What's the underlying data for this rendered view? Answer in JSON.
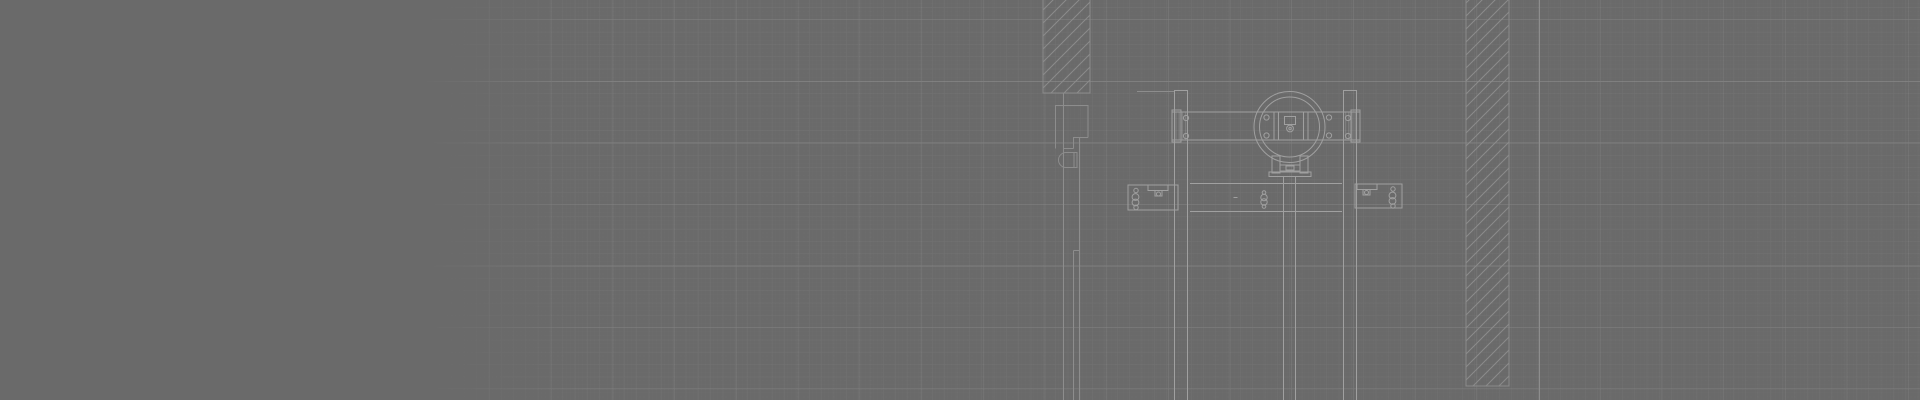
{
  "canvas": {
    "width": 1920,
    "height": 400,
    "background": "#6a6a6a",
    "line_color_bright": "#a0a0a0",
    "line_color_dim": "#8d8d8d",
    "hatch_color": "#8b8b8b",
    "section_fill_color": "rgba(255,255,255,0.16)",
    "grid": {
      "origin_x": 58,
      "origin_y": 20,
      "minor_spacing": 12.32,
      "major_spacing_x": 61.7,
      "major_spacing_y": 61.5,
      "fine_spacing": 4.1,
      "minor_color": "rgba(255,255,255,0.05)",
      "major_color": "rgba(255,255,255,0.115)",
      "fine_color": "rgba(255,255,255,0.02)",
      "fade_start_x": 420,
      "fade_full_x": 585
    }
  },
  "drawing": {
    "description": "CAD section detail: sliding-door trolley hanger assembly between hatched wall sections on gray drafting grid",
    "elements": [
      {
        "t": "hrect",
        "name": "wall-section-upper",
        "x": 1043,
        "y": -4,
        "w": 47,
        "h": 97
      },
      {
        "t": "hrect",
        "name": "wall-column-right",
        "x": 1466,
        "y": -6,
        "w": 43,
        "h": 392
      },
      {
        "t": "line",
        "name": "wall-face-line",
        "x1": 1539.5,
        "y1": 0,
        "x2": 1539.5,
        "y2": 400,
        "c": "dim"
      },
      {
        "t": "line",
        "name": "door-face-line",
        "x1": 1063.5,
        "y1": 93,
        "x2": 1063.5,
        "y2": 400,
        "c": "dim"
      },
      {
        "t": "line",
        "name": "jamb-top",
        "x1": 1055,
        "y1": 105.5,
        "x2": 1088.5,
        "y2": 105.5,
        "c": "dim"
      },
      {
        "t": "line",
        "name": "jamb-left",
        "x1": 1055.5,
        "y1": 105.5,
        "x2": 1055.5,
        "y2": 148.5,
        "c": "dim"
      },
      {
        "t": "line",
        "name": "jamb-right",
        "x1": 1088,
        "y1": 105.5,
        "x2": 1088,
        "y2": 137.5,
        "c": "dim"
      },
      {
        "t": "line",
        "name": "jamb-notch-h",
        "x1": 1073,
        "y1": 137.5,
        "x2": 1088,
        "y2": 137.5,
        "c": "dim"
      },
      {
        "t": "line",
        "name": "jamb-notch-v",
        "x1": 1073.5,
        "y1": 137.5,
        "x2": 1073.5,
        "y2": 148.5,
        "c": "dim"
      },
      {
        "t": "line",
        "name": "jamb-notch-h2",
        "x1": 1063.5,
        "y1": 148.5,
        "x2": 1073.5,
        "y2": 148.5,
        "c": "dim"
      },
      {
        "t": "path",
        "name": "door-handle-section",
        "d": "M 1077,152.5 H 1066 A 7.5 7.5 0 0 0 1066,167.5 H 1077 Z",
        "c": "dim"
      },
      {
        "t": "line",
        "name": "door-handle-inner",
        "x1": 1074,
        "y1": 152.5,
        "x2": 1074,
        "y2": 167.5,
        "c": "dim"
      },
      {
        "t": "line",
        "name": "door-track-line-a",
        "x1": 1079.5,
        "y1": 137.5,
        "x2": 1079.5,
        "y2": 400,
        "c": "dim"
      },
      {
        "t": "line",
        "name": "door-track-step",
        "x1": 1073.5,
        "y1": 250.5,
        "x2": 1079.5,
        "y2": 250.5,
        "c": "dim"
      },
      {
        "t": "line",
        "name": "door-track-line-b",
        "x1": 1073.5,
        "y1": 250.5,
        "x2": 1073.5,
        "y2": 400,
        "c": "dim"
      },
      {
        "t": "line",
        "name": "header-tick",
        "x1": 1137,
        "y1": 91.5,
        "x2": 1174,
        "y2": 91.5,
        "c": "dim"
      },
      {
        "t": "line",
        "name": "post-left-edge-a",
        "x1": 1174.5,
        "y1": 90,
        "x2": 1174.5,
        "y2": 400
      },
      {
        "t": "line",
        "name": "post-left-edge-b",
        "x1": 1187.5,
        "y1": 90,
        "x2": 1187.5,
        "y2": 400
      },
      {
        "t": "line",
        "name": "post-left-cap",
        "x1": 1174.5,
        "y1": 90.5,
        "x2": 1187.5,
        "y2": 90.5
      },
      {
        "t": "line",
        "name": "post-right-edge-a",
        "x1": 1343.5,
        "y1": 90,
        "x2": 1343.5,
        "y2": 400
      },
      {
        "t": "line",
        "name": "post-right-edge-b",
        "x1": 1356.5,
        "y1": 90,
        "x2": 1356.5,
        "y2": 400
      },
      {
        "t": "line",
        "name": "post-right-cap",
        "x1": 1343.5,
        "y1": 90.5,
        "x2": 1356.5,
        "y2": 90.5
      },
      {
        "t": "rect",
        "name": "trolley-beam",
        "x": 1172,
        "y": 112,
        "w": 188,
        "h": 28
      },
      {
        "t": "rect",
        "name": "beam-endcap-left",
        "x": 1172,
        "y": 110,
        "w": 9,
        "h": 32
      },
      {
        "t": "rect",
        "name": "beam-endcap-right",
        "x": 1351,
        "y": 110,
        "w": 9,
        "h": 32
      },
      {
        "t": "vrect",
        "name": "beam-post-section-left",
        "x": 1175,
        "y": 112.5,
        "w": 12,
        "h": 27
      },
      {
        "t": "vrect",
        "name": "beam-post-section-right",
        "x": 1344,
        "y": 112.5,
        "w": 12,
        "h": 27
      },
      {
        "t": "circle",
        "name": "roller-wheel-outer",
        "cx": 1289.5,
        "cy": 127,
        "r": 35.5
      },
      {
        "t": "circle",
        "name": "roller-wheel-inner",
        "cx": 1289.5,
        "cy": 127,
        "r": 30
      },
      {
        "t": "rect",
        "name": "center-plate",
        "x": 1274,
        "y": 112,
        "w": 34,
        "h": 28
      },
      {
        "t": "line",
        "name": "center-plate-inner-l",
        "x1": 1278.5,
        "y1": 112,
        "x2": 1278.5,
        "y2": 140
      },
      {
        "t": "line",
        "name": "center-plate-inner-r",
        "x1": 1303.5,
        "y1": 112,
        "x2": 1303.5,
        "y2": 140
      },
      {
        "t": "rect",
        "name": "hub-glyph",
        "x": 1284.5,
        "y": 116.5,
        "w": 11,
        "h": 8
      },
      {
        "t": "circle",
        "name": "hub-circle",
        "cx": 1290,
        "cy": 128.5,
        "r": 3.4
      },
      {
        "t": "circle",
        "name": "hub-dot",
        "cx": 1290,
        "cy": 128.5,
        "r": 1.2
      },
      {
        "t": "circle",
        "name": "beam-bolt",
        "cx": 1186,
        "cy": 118,
        "r": 2.6
      },
      {
        "t": "circle",
        "name": "beam-bolt",
        "cx": 1186,
        "cy": 136,
        "r": 2.6
      },
      {
        "t": "circle",
        "name": "beam-bolt",
        "cx": 1266.5,
        "cy": 117.5,
        "r": 2.6
      },
      {
        "t": "circle",
        "name": "beam-bolt",
        "cx": 1266.5,
        "cy": 135.5,
        "r": 2.6
      },
      {
        "t": "circle",
        "name": "beam-bolt",
        "cx": 1329,
        "cy": 117.5,
        "r": 2.6
      },
      {
        "t": "circle",
        "name": "beam-bolt",
        "cx": 1329,
        "cy": 135.5,
        "r": 2.6
      },
      {
        "t": "circle",
        "name": "beam-bolt",
        "cx": 1348,
        "cy": 118,
        "r": 2.6
      },
      {
        "t": "circle",
        "name": "beam-bolt",
        "cx": 1348,
        "cy": 136,
        "r": 2.6
      },
      {
        "t": "rect",
        "name": "roller-bracket-left",
        "x": 1272,
        "y": 156,
        "w": 8,
        "h": 17
      },
      {
        "t": "rect",
        "name": "roller-bracket-right",
        "x": 1300,
        "y": 156,
        "w": 8,
        "h": 17
      },
      {
        "t": "rect",
        "name": "roller-crossbar",
        "x": 1280,
        "y": 165,
        "w": 20,
        "h": 6
      },
      {
        "t": "rect",
        "name": "roller-crossbar-center",
        "x": 1286,
        "y": 166,
        "w": 8,
        "h": 4
      },
      {
        "t": "rect",
        "name": "roller-base-plate",
        "x": 1269,
        "y": 172,
        "w": 42,
        "h": 4.5
      },
      {
        "t": "line",
        "name": "hanger-rod-left",
        "x1": 1283.5,
        "y1": 176.5,
        "x2": 1283.5,
        "y2": 400
      },
      {
        "t": "line",
        "name": "hanger-rod-right",
        "x1": 1295.5,
        "y1": 176.5,
        "x2": 1295.5,
        "y2": 400
      },
      {
        "t": "line",
        "name": "rail-top",
        "x1": 1190,
        "y1": 183.5,
        "x2": 1342,
        "y2": 183.5
      },
      {
        "t": "line",
        "name": "rail-bottom",
        "x1": 1190,
        "y1": 211.5,
        "x2": 1342,
        "y2": 211.5
      },
      {
        "t": "rect",
        "name": "floor-bracket-left",
        "x": 1128,
        "y": 185,
        "w": 50,
        "h": 25
      },
      {
        "t": "circle",
        "name": "bracket-bolt",
        "cx": 1136,
        "cy": 190.5,
        "r": 2.2
      },
      {
        "t": "circle",
        "name": "bracket-bolt",
        "cx": 1135.5,
        "cy": 197,
        "r": 3.4
      },
      {
        "t": "circle",
        "name": "bracket-bolt",
        "cx": 1135.5,
        "cy": 202.5,
        "r": 3.4
      },
      {
        "t": "circle",
        "name": "bracket-bolt",
        "cx": 1136,
        "cy": 207.5,
        "r": 2.2
      },
      {
        "t": "rect",
        "name": "bracket-clamp",
        "x": 1148,
        "y": 185,
        "w": 20,
        "h": 5.5
      },
      {
        "t": "rect",
        "name": "bracket-clamp-stem",
        "x": 1155,
        "y": 190.5,
        "w": 7,
        "h": 5.5
      },
      {
        "t": "circle",
        "name": "bracket-clamp-bolt",
        "cx": 1158.5,
        "cy": 194,
        "r": 2
      },
      {
        "t": "rect",
        "name": "floor-bracket-right",
        "x": 1355,
        "y": 184,
        "w": 47,
        "h": 24
      },
      {
        "t": "circle",
        "name": "bracket-bolt",
        "cx": 1393,
        "cy": 189,
        "r": 2.2
      },
      {
        "t": "circle",
        "name": "bracket-bolt",
        "cx": 1392.5,
        "cy": 195.5,
        "r": 3.4
      },
      {
        "t": "circle",
        "name": "bracket-bolt",
        "cx": 1392.5,
        "cy": 201,
        "r": 3.4
      },
      {
        "t": "circle",
        "name": "bracket-bolt",
        "cx": 1393,
        "cy": 206,
        "r": 2.2
      },
      {
        "t": "rect",
        "name": "bracket-clamp",
        "x": 1357,
        "y": 184,
        "w": 20,
        "h": 5.5
      },
      {
        "t": "rect",
        "name": "bracket-clamp-stem",
        "x": 1363,
        "y": 189.5,
        "w": 7,
        "h": 5.5
      },
      {
        "t": "circle",
        "name": "bracket-clamp-bolt",
        "cx": 1366.5,
        "cy": 192.5,
        "r": 2
      },
      {
        "t": "circle",
        "name": "anchor-bolt",
        "cx": 1264,
        "cy": 192.5,
        "r": 1.8
      },
      {
        "t": "circle",
        "name": "anchor-bolt",
        "cx": 1264,
        "cy": 197.5,
        "r": 3.2
      },
      {
        "t": "circle",
        "name": "anchor-bolt",
        "cx": 1264,
        "cy": 202,
        "r": 3.2
      },
      {
        "t": "circle",
        "name": "anchor-bolt",
        "cx": 1264,
        "cy": 206.5,
        "r": 1.8
      },
      {
        "t": "line",
        "name": "center-tick",
        "x1": 1233.5,
        "y1": 197.5,
        "x2": 1237.5,
        "y2": 197.5
      }
    ]
  }
}
